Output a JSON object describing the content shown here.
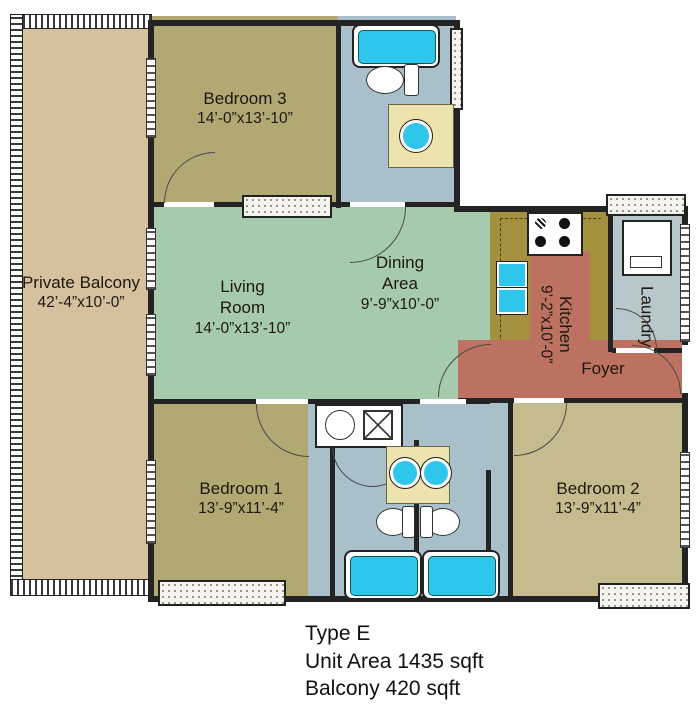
{
  "caption": {
    "lines": [
      "Type E",
      "Unit Area 1435 sqft",
      "Balcony 420 sqft"
    ]
  },
  "rooms": {
    "balcony": {
      "label": "Private Balcony",
      "dims": "42’-4”x10’-0”"
    },
    "bedroom3": {
      "label": "Bedroom 3",
      "dims": "14’-0”x13’-10”"
    },
    "living": {
      "label": "Living Room",
      "dims": "14’-0”x13’-10”"
    },
    "dining": {
      "label": "Dining Area",
      "dims": "9’-9”x10’-0”"
    },
    "kitchen": {
      "label": "Kitchen",
      "dims": "9’-2”x10’-0”"
    },
    "laundry": {
      "label": "Laundry"
    },
    "foyer": {
      "label": "Foyer"
    },
    "bedroom1": {
      "label": "Bedroom 1",
      "dims": "13’-9”x11’-4”"
    },
    "bedroom2": {
      "label": "Bedroom 2",
      "dims": "13’-9”x11’-4”"
    }
  },
  "colors": {
    "balcony": "#d5c19e",
    "bedroom": "#b1a973",
    "bedroom2": "#c4bc8e",
    "mint": "#a6cbac",
    "bath": "#a9bfca",
    "laundry": "#b7c7cb",
    "kitchen": "#a3913f",
    "salmon": "#bd7261",
    "counter": "#ece4ae",
    "fixture": "#2ec6ea",
    "wall": "#232323"
  }
}
